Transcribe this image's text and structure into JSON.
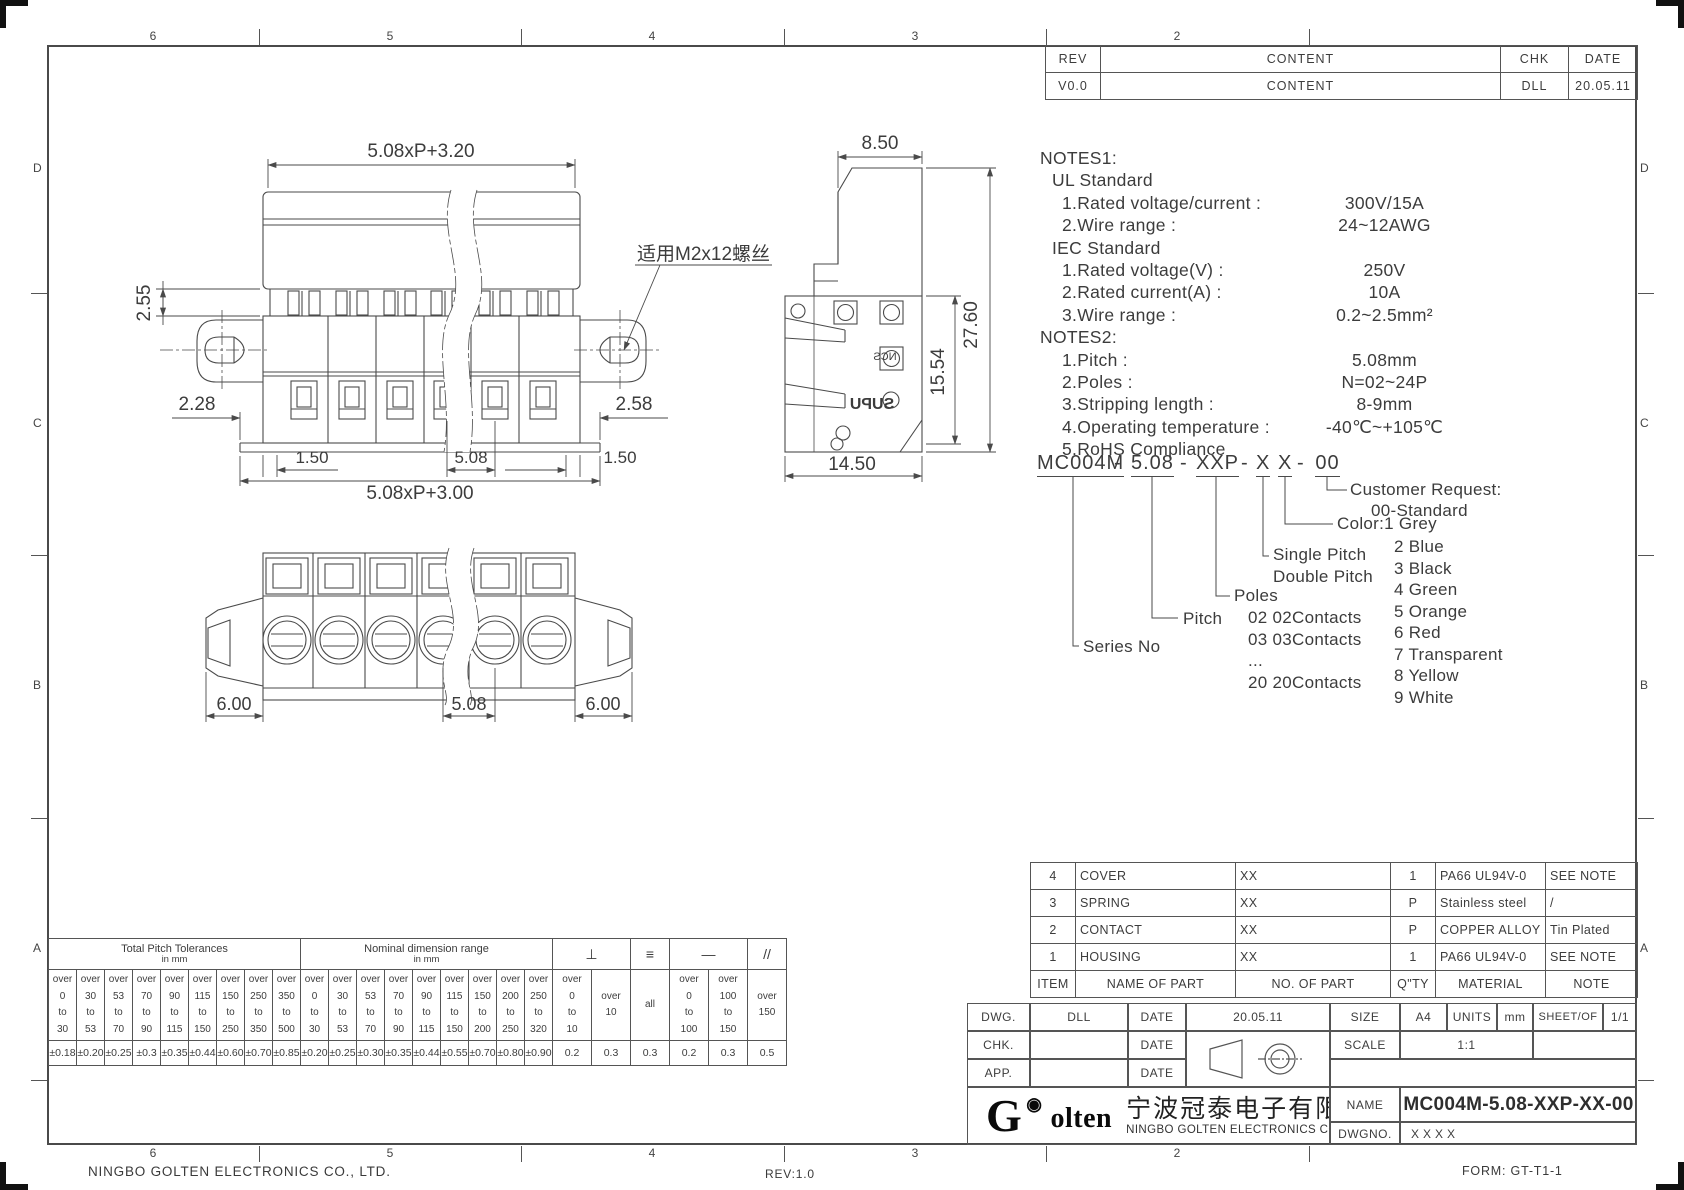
{
  "sheet": {
    "company_footer": "NINGBO GOLTEN ELECTRONICS CO., LTD.",
    "rev_footer": "REV:1.0",
    "form_footer": "FORM: GT-T1-1"
  },
  "zones": {
    "top": [
      "6",
      "5",
      "4",
      "3",
      "2"
    ],
    "bottom": [
      "6",
      "5",
      "4",
      "3",
      "2"
    ],
    "left": [
      "D",
      "C",
      "B",
      "A"
    ],
    "right": [
      "D",
      "C",
      "B",
      "A"
    ]
  },
  "revision": {
    "headers": [
      "REV",
      "CONTENT",
      "CHK",
      "DATE"
    ],
    "rows": [
      [
        "V0.0",
        "CONTENT",
        "DLL",
        "20.05.11"
      ]
    ]
  },
  "notes": {
    "lines": [
      {
        "label": "NOTES1:",
        "value": "",
        "indent": 0
      },
      {
        "label": "UL Standard",
        "value": "",
        "indent": 12
      },
      {
        "label": "1.Rated voltage/current :",
        "value": "300V/15A",
        "indent": 22
      },
      {
        "label": "2.Wire range :",
        "value": "24~12AWG",
        "indent": 22
      },
      {
        "label": "IEC Standard",
        "value": "",
        "indent": 12
      },
      {
        "label": "1.Rated voltage(V) :",
        "value": "250V",
        "indent": 22
      },
      {
        "label": "2.Rated current(A) :",
        "value": "10A",
        "indent": 22
      },
      {
        "label": "3.Wire range :",
        "value": "0.2~2.5mm²",
        "indent": 22
      },
      {
        "label": "NOTES2:",
        "value": "",
        "indent": 0
      },
      {
        "label": "1.Pitch :",
        "value": "5.08mm",
        "indent": 22
      },
      {
        "label": "2.Poles :",
        "value": "N=02~24P",
        "indent": 22
      },
      {
        "label": "3.Stripping length :",
        "value": "8-9mm",
        "indent": 22
      },
      {
        "label": "4.Operating temperature :",
        "value": "-40℃~+105℃",
        "indent": 22
      },
      {
        "label": "5.RoHS  Compliance",
        "value": "",
        "indent": 22
      }
    ]
  },
  "ordering": {
    "segments": [
      {
        "t": "MC004M",
        "u": true,
        "x": 1037,
        "w": 72
      },
      {
        "t": "-",
        "x": 1114
      },
      {
        "t": "5.08",
        "u": true,
        "x": 1131,
        "w": 42
      },
      {
        "t": "-",
        "x": 1180
      },
      {
        "t": "XXP",
        "u": true,
        "x": 1196,
        "w": 40
      },
      {
        "t": "-",
        "x": 1241
      },
      {
        "t": "X",
        "u": true,
        "x": 1256,
        "w": 14
      },
      {
        "t": "X",
        "u": true,
        "x": 1278,
        "w": 14
      },
      {
        "t": "-",
        "x": 1297
      },
      {
        "t": "00",
        "u": true,
        "x": 1315,
        "w": 25
      }
    ],
    "series_label": "Series No",
    "pitch_label": "Pitch",
    "poles_label": "Poles",
    "poles_items": [
      "02 02Contacts",
      "03 03Contacts",
      "...",
      "20 20Contacts"
    ],
    "single_pitch": "Single Pitch",
    "double_pitch": "Double Pitch",
    "color_label": "Color:1 Grey",
    "color_items": [
      "2 Blue",
      "3 Black",
      "4 Green",
      "5 Orange",
      "6 Red",
      "7 Transparent",
      "8 Yellow",
      "9 White"
    ],
    "customer_label": "Customer Request:",
    "customer_value": "00-Standard"
  },
  "views": {
    "front": {
      "dim_top": "5.08xP+3.20",
      "dim_pin_height": "2.55",
      "dim_left_offset": "2.28",
      "dim_right_offset": "2.58",
      "dim_b_left": "1.50",
      "dim_pitch": "5.08",
      "dim_b_right": "1.50",
      "dim_bottom": "5.08xP+3.00",
      "screw_note": "适用M2x12螺丝"
    },
    "side": {
      "dim_width": "8.50",
      "dim_total_height": "27.60",
      "dim_body_height": "15.54",
      "dim_depth": "14.50",
      "brand_upper": "NCS",
      "brand_lower": "SUPU"
    },
    "bottom": {
      "dim_ear_left": "6.00",
      "dim_pitch": "5.08",
      "dim_ear_right": "6.00"
    }
  },
  "bom": {
    "headers": [
      "ITEM",
      "NAME OF PART",
      "NO. OF PART",
      "Q\"TY",
      "MATERIAL",
      "NOTE"
    ],
    "rows": [
      [
        "4",
        "COVER",
        "XX",
        "1",
        "PA66 UL94V-0",
        "SEE NOTE"
      ],
      [
        "3",
        "SPRING",
        "XX",
        "P",
        "Stainless steel",
        "/"
      ],
      [
        "2",
        "CONTACT",
        "XX",
        "P",
        "COPPER ALLOY",
        "Tin Plated"
      ],
      [
        "1",
        "HOUSING",
        "XX",
        "1",
        "PA66 UL94V-0",
        "SEE NOTE"
      ]
    ]
  },
  "titleblock": {
    "dwg_label": "DWG.",
    "dwg_value": "DLL",
    "date_label": "DATE",
    "dwg_date": "20.05.11",
    "chk_label": "CHK.",
    "app_label": "APP.",
    "size_label": "SIZE",
    "size_value": "A4",
    "units_label": "UNITS",
    "units_value": "mm",
    "sheet_label": "SHEET/OF",
    "sheet_value": "1/1",
    "scale_label": "SCALE",
    "scale_value": "1:1",
    "name_label": "NAME",
    "name_value": "MC004M-5.08-XXP-XX-00",
    "dwgno_label": "DWGNO.",
    "dwgno_value": "XXXX",
    "logo_g": "G",
    "logo_rest": "olten",
    "company_cn": "宁波冠泰电子有限公司",
    "company_en": "NINGBO GOLTEN ELECTRONICS CO., LTD."
  },
  "tolerances": {
    "groups": [
      {
        "title": "Total Pitch Tolerances",
        "sub": "in mm",
        "span": 9
      },
      {
        "title": "Nominal dimension range",
        "sub": "in mm",
        "span": 9
      },
      {
        "sym": "⊥",
        "span": 2
      },
      {
        "sym": "≡",
        "span": 1
      },
      {
        "sym": "—",
        "span": 2
      },
      {
        "sym": "//",
        "span": 1
      }
    ],
    "ranges": [
      [
        "over",
        "0",
        "to",
        "30"
      ],
      [
        "over",
        "30",
        "to",
        "53"
      ],
      [
        "over",
        "53",
        "to",
        "70"
      ],
      [
        "over",
        "70",
        "to",
        "90"
      ],
      [
        "over",
        "90",
        "to",
        "115"
      ],
      [
        "over",
        "115",
        "to",
        "150"
      ],
      [
        "over",
        "150",
        "to",
        "250"
      ],
      [
        "over",
        "250",
        "to",
        "350"
      ],
      [
        "over",
        "350",
        "to",
        "500"
      ],
      [
        "over",
        "0",
        "to",
        "30"
      ],
      [
        "over",
        "30",
        "to",
        "53"
      ],
      [
        "over",
        "53",
        "to",
        "70"
      ],
      [
        "over",
        "70",
        "to",
        "90"
      ],
      [
        "over",
        "90",
        "to",
        "115"
      ],
      [
        "over",
        "115",
        "to",
        "150"
      ],
      [
        "over",
        "150",
        "to",
        "200"
      ],
      [
        "over",
        "200",
        "to",
        "250"
      ],
      [
        "over",
        "250",
        "to",
        "320"
      ],
      [
        "over",
        "0",
        "to",
        "10"
      ],
      [
        "over",
        "10"
      ],
      [
        "all"
      ],
      [
        "over",
        "0",
        "to",
        "100"
      ],
      [
        "over",
        "100",
        "to",
        "150"
      ],
      [
        "over",
        "150"
      ]
    ],
    "values": [
      "±0.18",
      "±0.20",
      "±0.25",
      "±0.3",
      "±0.35",
      "±0.44",
      "±0.60",
      "±0.70",
      "±0.85",
      "±0.20",
      "±0.25",
      "±0.30",
      "±0.35",
      "±0.44",
      "±0.55",
      "±0.70",
      "±0.80",
      "±0.90",
      "0.2",
      "0.3",
      "0.3",
      "0.2",
      "0.3",
      "0.5"
    ]
  }
}
